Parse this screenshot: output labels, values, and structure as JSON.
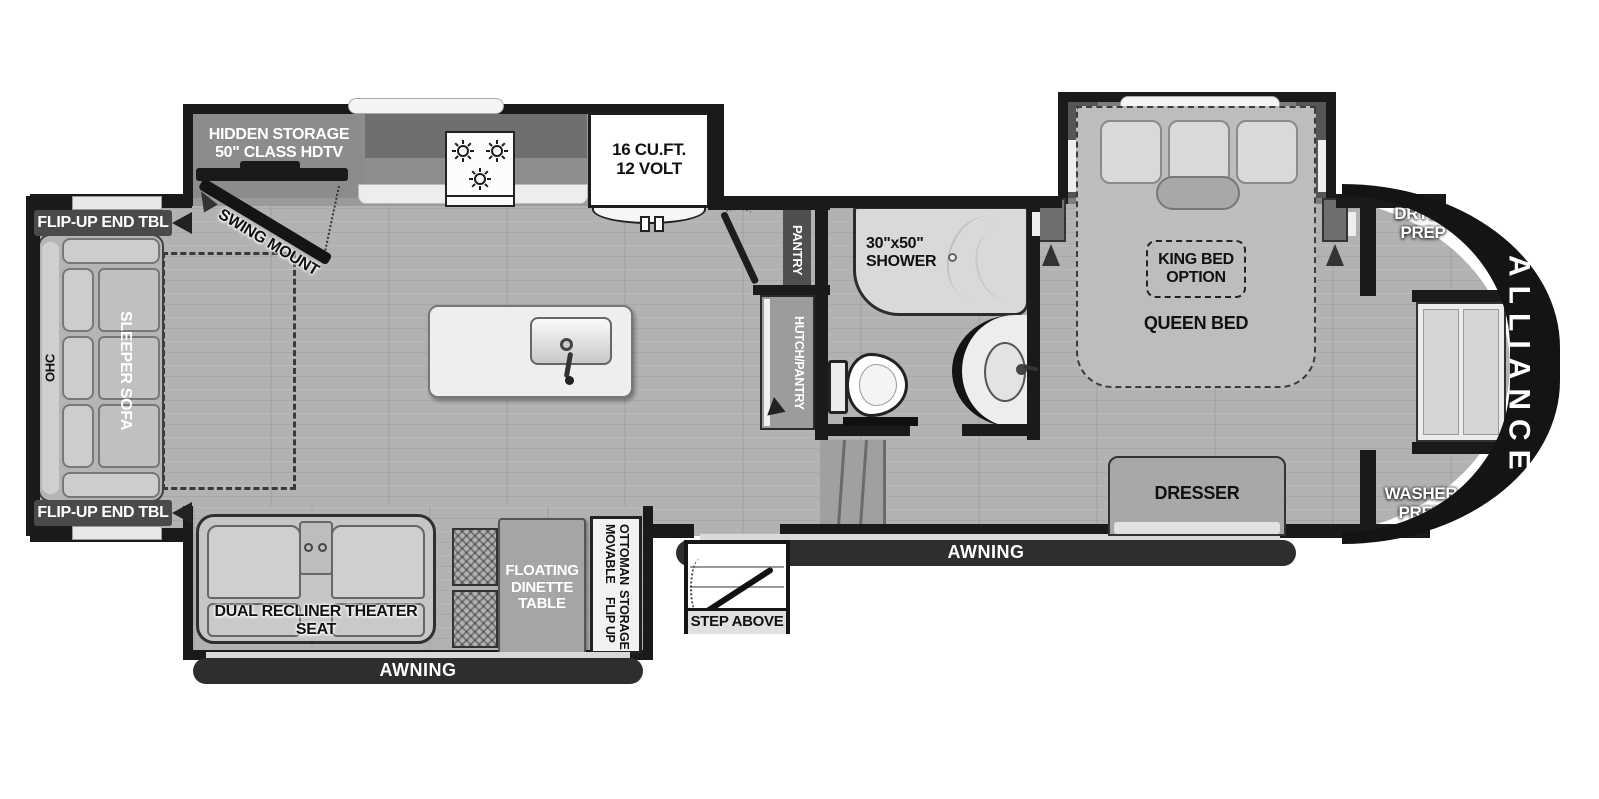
{
  "labels": {
    "hidden_storage_1": "HIDDEN STORAGE",
    "hidden_storage_2": "50\" CLASS HDTV",
    "swing_mount": "SWING MOUNT",
    "fridge_1": "16 CU.FT.",
    "fridge_2": "12 VOLT",
    "flip_up_end_tbl": "FLIP-UP END TBL",
    "ohc": "OHC",
    "sleeper_sofa": "SLEEPER SOFA",
    "pantry": "PANTRY",
    "hutch_pantry": "HUTCH/PANTRY",
    "shower_1": "30\"x50\"",
    "shower_2": "SHOWER",
    "king_bed_1": "KING BED",
    "king_bed_2": "OPTION",
    "queen_bed": "QUEEN BED",
    "dresser": "DRESSER",
    "dryer_1": "DRYER",
    "dryer_2": "PREP",
    "washer_1": "WASHER",
    "washer_2": "PREP",
    "brand": "ALLIANCE",
    "awning": "AWNING",
    "step_above": "STEP ABOVE",
    "theater_seat": "DUAL RECLINER THEATER SEAT",
    "dinette_1": "FLOATING",
    "dinette_2": "DINETTE",
    "dinette_3": "TABLE",
    "ottoman_1": "MOVABLE OTTOMAN",
    "ottoman_2": "FLIP UP STORAGE"
  },
  "colors": {
    "wall": "#1a1a1a",
    "floor": "#b2b2b2",
    "slide_interior": "#9a9a9a",
    "accent_white": "#ffffff"
  }
}
